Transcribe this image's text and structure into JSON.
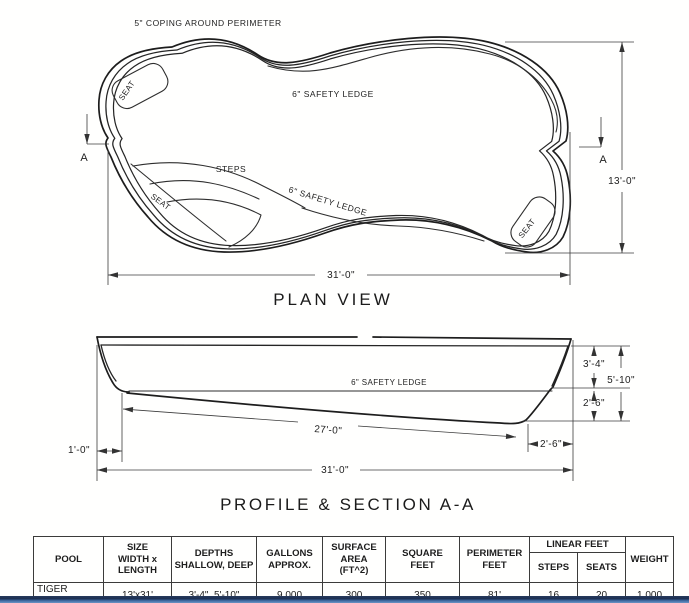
{
  "plan": {
    "coping_label": "5\" COPING AROUND PERIMETER",
    "safety_ledge_top": "6\" SAFETY LEDGE",
    "safety_ledge_mid": "6\" SAFETY LEDGE",
    "steps_label": "STEPS",
    "seat_top_left": "SEAT",
    "seat_bench": "SEAT",
    "seat_bottom_right": "SEAT",
    "section_marker_left": "A",
    "section_marker_right": "A",
    "width_dim": "13'-0\"",
    "length_dim": "31'-0\"",
    "title": "PLAN VIEW"
  },
  "profile": {
    "safety_ledge": "6\" SAFETY LEDGE",
    "slope_dim": "27'-0\"",
    "shallow_depth_dim": "3'-4\"",
    "overall_depth_dim": "5'-10\"",
    "ledge_to_floor_dim": "2'-6\"",
    "deep_end_width_dim": "2'-6\"",
    "shallow_offset_dim": "1'-0\"",
    "length_dim": "31'-0\"",
    "title": "PROFILE & SECTION A-A"
  },
  "table": {
    "headers": {
      "pool": "POOL",
      "size": [
        "SIZE",
        "WIDTH x",
        "LENGTH"
      ],
      "depths": [
        "DEPTHS",
        "SHALLOW, DEEP"
      ],
      "gallons": [
        "GALLONS",
        "APPROX."
      ],
      "surface": [
        "SURFACE",
        "AREA",
        "(FT^2)"
      ],
      "square": [
        "SQUARE",
        "FEET"
      ],
      "perimeter": [
        "PERIMETER",
        "FEET"
      ],
      "linear_group": "LINEAR FEET",
      "steps": "STEPS",
      "seats": "SEATS",
      "weight": "WEIGHT"
    },
    "row": {
      "pool": "TIGER SHARK",
      "size": "13'x31'",
      "depths": "3'-4\", 5'-10\"",
      "gallons": "9,000",
      "surface": "300",
      "square": "350",
      "perimeter": "81'",
      "steps": "16",
      "seats": "20",
      "weight": "1,000"
    }
  }
}
